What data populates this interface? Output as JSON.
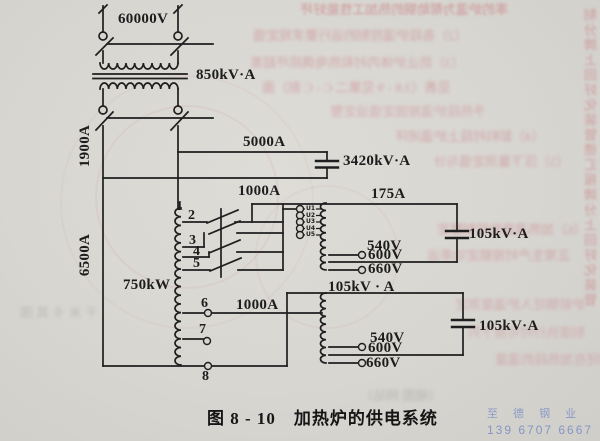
{
  "labels": {
    "v60000": "60000V",
    "t850": "850kV·A",
    "a1900": "1900A",
    "a5000": "5000A",
    "c3420": "3420kV·A",
    "a1000u": "1000A",
    "a175": "175A",
    "a6500": "6500A",
    "t1": "1",
    "t2": "2",
    "t3": "3",
    "t4": "4",
    "t5": "5",
    "u1": "U1",
    "u2": "U2",
    "u3": "U3",
    "u4": "U4",
    "u5": "U5",
    "v540u": "540V",
    "v600u": "600V",
    "v660u": "660V",
    "c105u": "105kV·A",
    "p750": "750kW",
    "c105m": "105kV · A",
    "t6": "6",
    "a1000l": "1000A",
    "t7": "7",
    "t8": "8",
    "v540l": "540V",
    "v600l": "600V",
    "v660l": "660V",
    "c105l": "105kV·A"
  },
  "caption": {
    "number": "图 8 - 10",
    "title": "加热炉的供电系统"
  },
  "watermark": {
    "line1": "至 德 钢 业",
    "line2": "139 6707 6667"
  },
  "bleed": {
    "lines": [
      "率的炉温为帮助钢的热加工性能好坏",
      "（2）各段炉温控制的运行要求规定值",
      "（3）防止炉体内衬和热电偶损坏超差",
      "见表（3.8 - 9 见第二 C - C 剖）面",
      "予热段炉温按固定值设定整",
      "（4）卸料时段上炉温闭环",
      "（5）压下量测定值与计",
      "（6）加热温度的控制整定",
      "正常生产时按额定功率运",
      "炉前钢坯入炉温度测定",
      "制度执行时可按下列",
      "钢坯在加热段的温度",
      "干 米 卡 其 围",
      "（缩图 网站）",
      "制分牌上回好化装管德汇报牌分上回好化装管"
    ]
  }
}
